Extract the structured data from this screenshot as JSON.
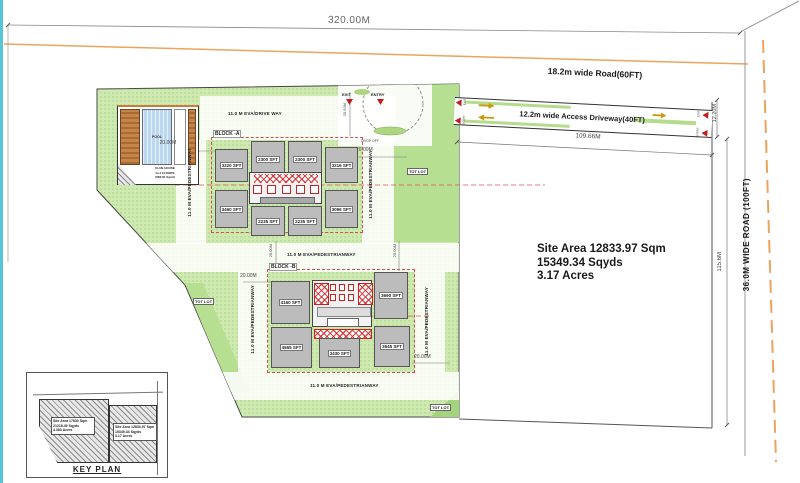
{
  "site": {
    "area_line1": "Site Area 12833.97 Sqm",
    "area_line2": "15349.34 Sqyds",
    "area_line3": "3.17 Acres"
  },
  "roads": {
    "top_road_label": "18.2m wide Road(60FT)",
    "access_driveway_label": "12.2m wide Access Driveway(40FT)",
    "right_road_label": "36.0M WIDE ROAD (100FT)"
  },
  "dimensions": {
    "site_width": "320.00M",
    "driveway_length": "109.66M",
    "driveway_width": "12.20M",
    "plot_depth": "115.6M",
    "setback_20": "20.00M",
    "drop_off_depth": "20.93M"
  },
  "labels": {
    "drive_way": "11.0 M EVA/DRIVE WAY",
    "pedestrian_way": "11.0 M EVA/PEDESTRIANWAY",
    "tot_lot": "TOT LOT",
    "pool": "POOL",
    "club_house_1": "CLUB HOUSE",
    "club_house_2": "G+4 FLOORS",
    "club_house_3": "(683.81 Sqmt)",
    "drop_off": "DROP OFF",
    "entry": "ENTRY",
    "exit": "EXIT"
  },
  "block_a": {
    "name": "BLOCK -A",
    "units": [
      {
        "label": "3220 SFT"
      },
      {
        "label": "2300 SFT"
      },
      {
        "label": "2300 SFT"
      },
      {
        "label": "3216 SFT"
      },
      {
        "label": "3460 SFT"
      },
      {
        "label": "2235 SFT"
      },
      {
        "label": "2235 SFT"
      },
      {
        "label": "3096 SFT"
      }
    ]
  },
  "block_b": {
    "name": "BLOCK -B",
    "units": [
      {
        "label": "4160 SFT"
      },
      {
        "label": "3690 SFT"
      },
      {
        "label": "4565 SFT"
      },
      {
        "label": "3430 SFT"
      },
      {
        "label": "3645 SFT"
      }
    ]
  },
  "key_plan": {
    "title": "KEY PLAN",
    "left_parcel": [
      "Site Area 17830 Sqm",
      "21218.49 Sqyds",
      "4.383 Acres"
    ],
    "right_parcel": [
      "Site Area 12833.97 Sqm",
      "15349.34 Sqyds",
      "3.17 Acres"
    ]
  },
  "colors": {
    "site_green": "#cfeab0",
    "dark_green": "#b7df92",
    "building_gray": "#bcbcbc",
    "accent_red": "#c02020",
    "property_orange": "#eba45e",
    "pool_blue": "#bcd8f0",
    "deck_brown": "#b5763a"
  }
}
